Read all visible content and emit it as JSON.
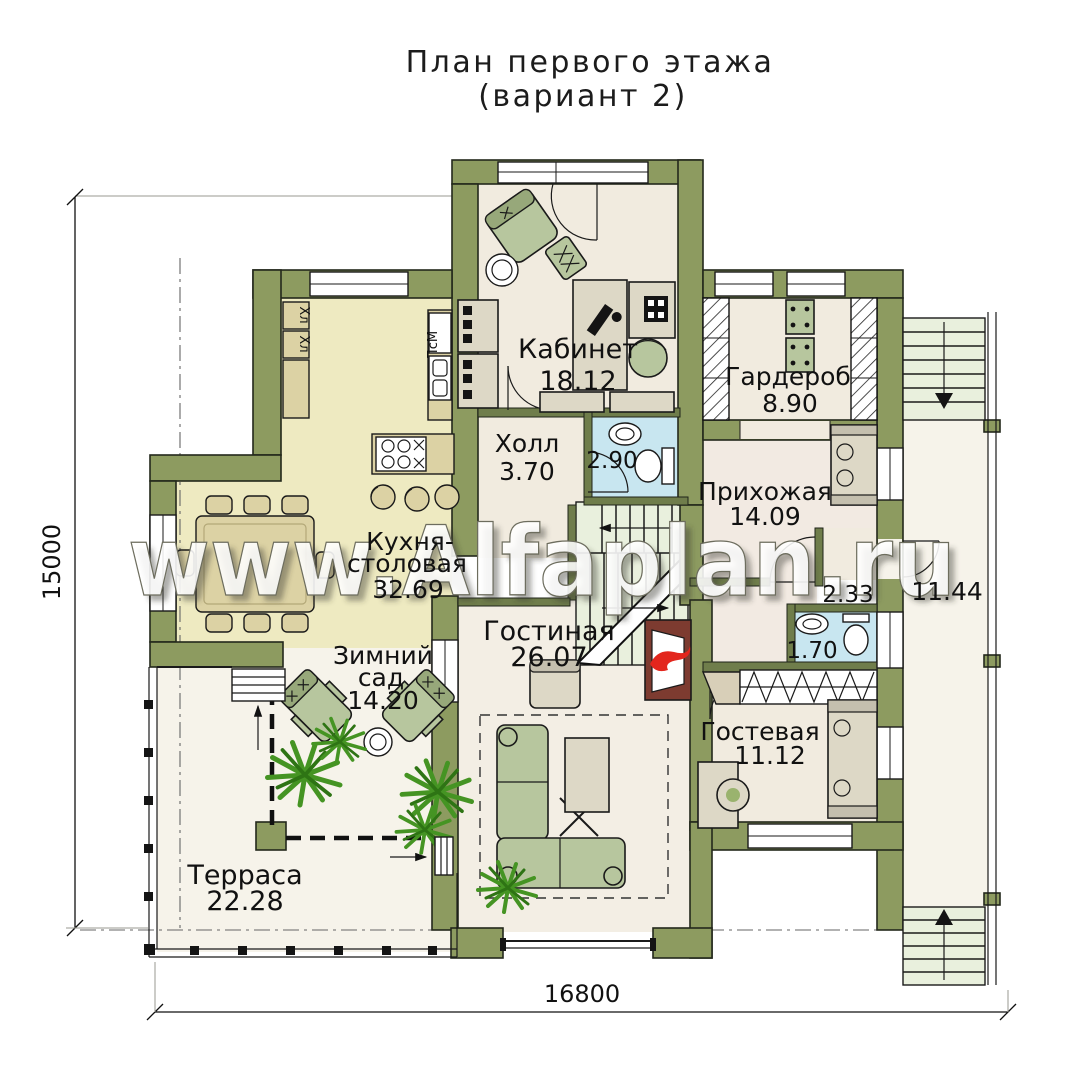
{
  "title": {
    "line1": "План первого этажа",
    "line2": "(вариант 2)"
  },
  "watermark": {
    "text": "www.Alfaplan.ru"
  },
  "dimensions": {
    "horizontal": "16800",
    "vertical": "15000"
  },
  "rooms": {
    "kabinet": {
      "name": "Кабинет",
      "area": "18.12"
    },
    "garderob": {
      "name": "Гардероб",
      "area": "8.90"
    },
    "holl": {
      "name": "Холл",
      "area": "3.70"
    },
    "sanuzel_1": {
      "area": "2.90"
    },
    "prihozhaya": {
      "name": "Прихожая",
      "area": "14.09"
    },
    "kladovaya": {
      "area": "2.33"
    },
    "sanuzel_2": {
      "area": "1.70"
    },
    "balkon": {
      "area": "11.44"
    },
    "kuhnya": {
      "name_line1": "Кухня-",
      "name_line2": "столовая",
      "area": "32.69"
    },
    "zimniy_sad": {
      "name_line1": "Зимний",
      "name_line2": "сад",
      "area": "14.20"
    },
    "gostinaya": {
      "name": "Гостиная",
      "area": "26.07"
    },
    "gostevaya": {
      "name": "Гостевая",
      "area": "11.12"
    },
    "terrasa": {
      "name": "Терраса",
      "area": "22.28"
    }
  },
  "appliances": {
    "fridge_top": "Хл",
    "fridge_bottom": "Хл",
    "dishwasher": "ПсМ"
  },
  "colors": {
    "wall": "#8d9b60",
    "floor": "#f1ebdf",
    "kitchen_floor": "#eeeac1",
    "bath_floor": "#c8e6f0",
    "stair_tread": "#e9f0dd",
    "fire_accent": "#e3261d"
  }
}
